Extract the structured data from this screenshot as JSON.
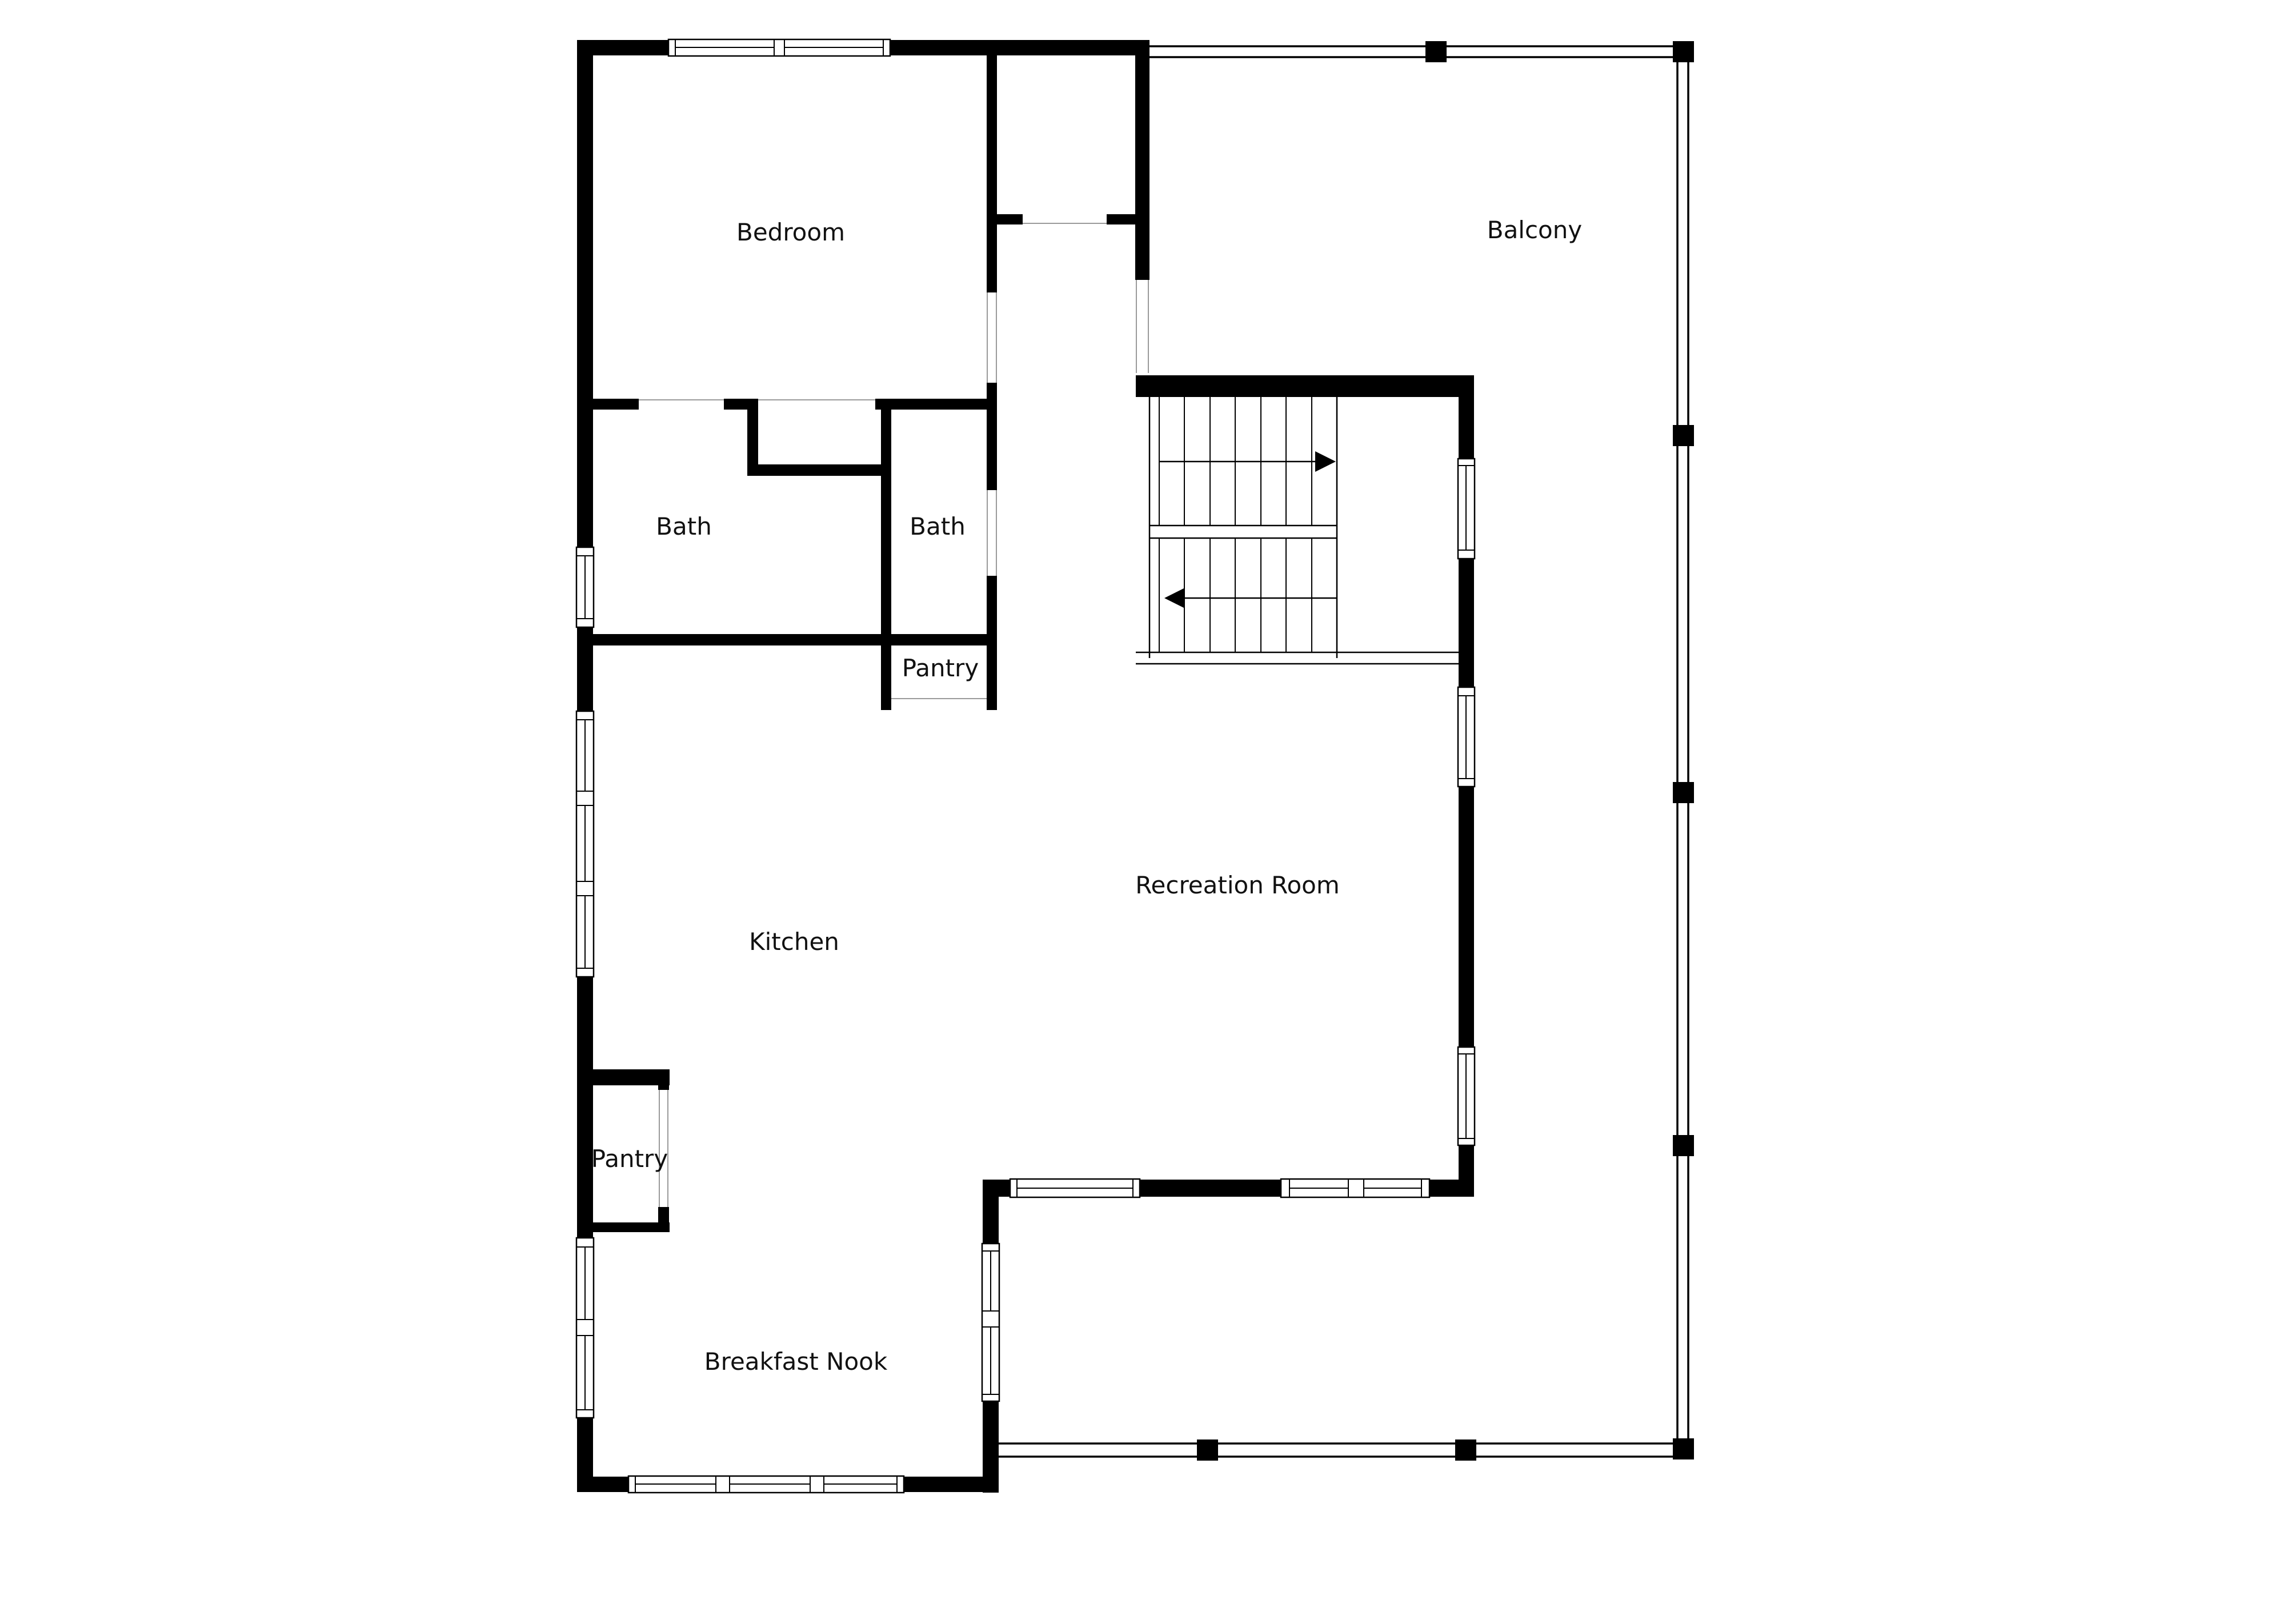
{
  "drawing": {
    "type": "floor-plan",
    "background": "#ffffff",
    "colors": {
      "wall": "#000000",
      "window_frame": "#000000",
      "door_opening_line": "#9a9a9a",
      "label_text": "#111111"
    }
  },
  "rooms": [
    {
      "id": "bedroom",
      "label": "Bedroom"
    },
    {
      "id": "balcony",
      "label": "Balcony"
    },
    {
      "id": "bath-left",
      "label": "Bath"
    },
    {
      "id": "bath-right",
      "label": "Bath"
    },
    {
      "id": "pantry-upper",
      "label": "Pantry"
    },
    {
      "id": "kitchen",
      "label": "Kitchen"
    },
    {
      "id": "recreation-room",
      "label": "Recreation Room"
    },
    {
      "id": "pantry-lower",
      "label": "Pantry"
    },
    {
      "id": "breakfast-nook",
      "label": "Breakfast Nook"
    }
  ],
  "stairs": {
    "up_run_direction": "right",
    "down_run_direction": "left"
  }
}
